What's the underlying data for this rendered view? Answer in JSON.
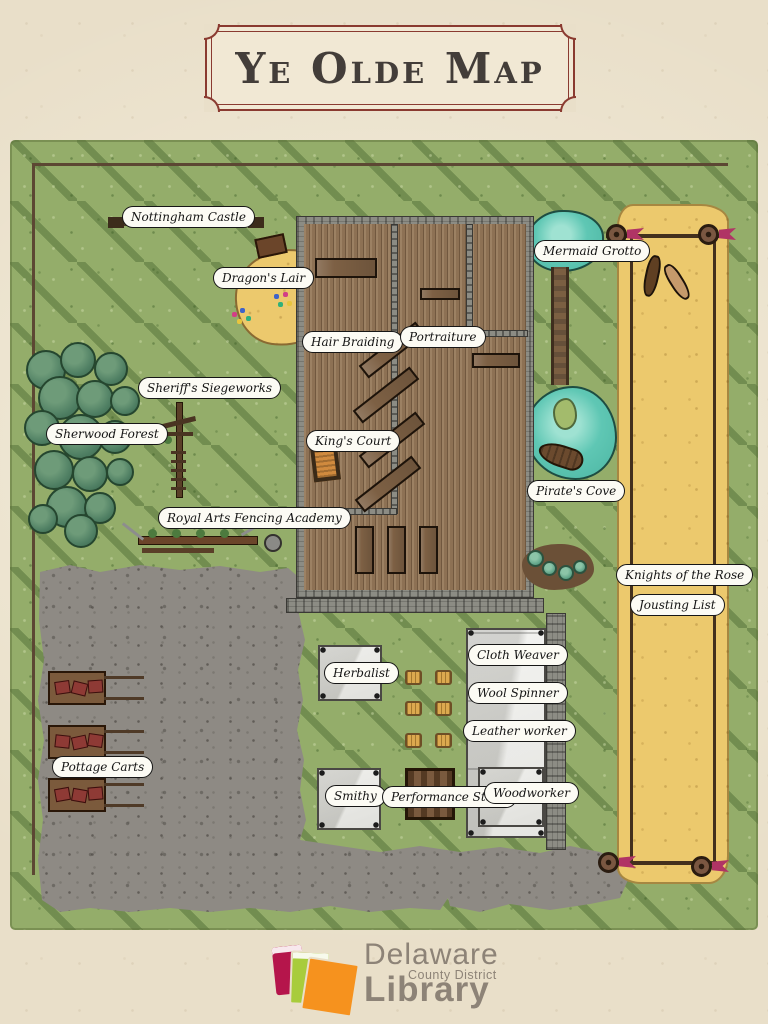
{
  "title": {
    "banner": "Ye Olde Map"
  },
  "map": {
    "labels": {
      "nottingham_castle": "Nottingham Castle",
      "dragons_lair": "Dragon's Lair",
      "mermaid_grotto": "Mermaid Grotto",
      "sherwood_forest": "Sherwood Forest",
      "sheriffs_siegeworks": "Sheriff's Siegeworks",
      "hair_braiding": "Hair Braiding",
      "portraiture": "Portraiture",
      "kings_court": "King's Court",
      "pirates_cove": "Pirate's Cove",
      "royal_arts_fencing_academy": "Royal Arts Fencing Academy",
      "knights_of_the_rose": "Knights of the Rose",
      "jousting_list": "Jousting List",
      "pottage_carts": "Pottage Carts",
      "herbalist": "Herbalist",
      "cloth_weaver": "Cloth Weaver",
      "wool_spinner": "Wool Spinner",
      "leather_worker": "Leather worker",
      "smithy": "Smithy",
      "performance_stage": "Performance Stage",
      "woodworker": "Woodworker"
    }
  },
  "footer": {
    "library": {
      "line1": "Delaware",
      "line2": "County District",
      "line3": "Library"
    }
  },
  "colors": {
    "parchment": "#e9dfc9",
    "grass": "#94ad6a",
    "sand": "#ecc96d",
    "water": "#5fc7b4",
    "gravel": "#8e8a84",
    "wood": "#8d7154",
    "banner_border": "#8a3a30",
    "flag_magenta": "#b03465",
    "book_crimson": "#b5154b",
    "book_lime": "#a8cc3c",
    "book_orange": "#f6921e",
    "logo_text": "#8d8377"
  }
}
